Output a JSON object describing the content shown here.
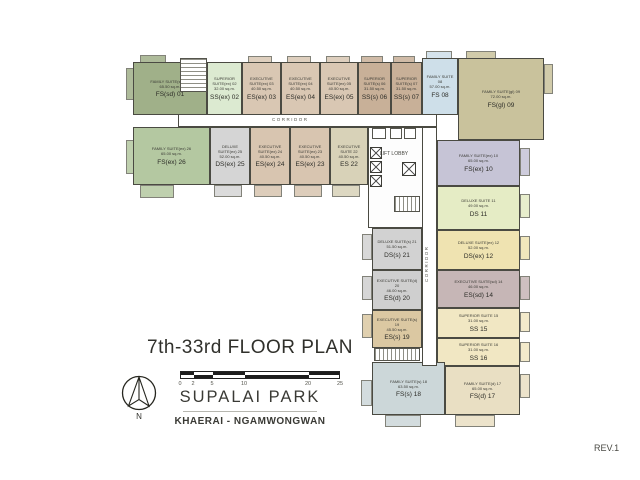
{
  "page": {
    "revision": "REV.1"
  },
  "title_block": {
    "title": "7th-33rd FLOOR PLAN",
    "project": "SUPALAI PARK",
    "location": "KHAERAI - NGAMWONGWAN",
    "north_label": "N",
    "scale_ticks": [
      "0",
      "2",
      "5",
      "10",
      "20",
      "25"
    ]
  },
  "labels": {
    "corridor_h": "CORRIDOR",
    "corridor_v": "CORRIDOR",
    "lift_lobby": "LIFT LOBBY"
  },
  "units": [
    {
      "number": "01",
      "name": "FAMILY SUITE(sd) 01",
      "area": "65.50 sq.m.",
      "code": "FS(sd) 01",
      "color": "#a0b089"
    },
    {
      "number": "02",
      "name": "SUPERIOR SUITE(ex) 02",
      "area": "32.00 sq.m.",
      "code": "SS(ex) 02",
      "color": "#dcead1"
    },
    {
      "number": "03",
      "name": "EXECUTIVE SUITE(ex) 03",
      "area": "40.50 sq.m.",
      "code": "ES(ex) 03",
      "color": "#d9c7b3"
    },
    {
      "number": "04",
      "name": "EXECUTIVE SUITE(ex) 04",
      "area": "40.50 sq.m.",
      "code": "ES(ex) 04",
      "color": "#d9c7b3"
    },
    {
      "number": "05",
      "name": "EXECUTIVE SUITE(ex) 05",
      "area": "40.50 sq.m.",
      "code": "ES(ex) 05",
      "color": "#d9c7b3"
    },
    {
      "number": "06",
      "name": "SUPERIOR SUITE(s) 06",
      "area": "31.50 sq.m.",
      "code": "SS(s) 06",
      "color": "#c8b098"
    },
    {
      "number": "07",
      "name": "SUPERIOR SUITE(s) 07",
      "area": "31.50 sq.m.",
      "code": "SS(s) 07",
      "color": "#c8b098"
    },
    {
      "number": "08",
      "name": "FAMILY SUITE 08",
      "area": "57.00 sq.m.",
      "code": "FS 08",
      "color": "#cedfe9"
    },
    {
      "number": "09",
      "name": "FAMILY SUITE(gl) 09",
      "area": "72.00 sq.m.",
      "code": "FS(gl) 09",
      "color": "#c9c29c"
    },
    {
      "number": "10",
      "name": "FAMILY SUITE(ex) 10",
      "area": "65.00 sq.m.",
      "code": "FS(ex) 10",
      "color": "#c6c4d6"
    },
    {
      "number": "11",
      "name": "DELUXE SUITE 11",
      "area": "49.00 sq.m.",
      "code": "DS 11",
      "color": "#e5ecc5"
    },
    {
      "number": "12",
      "name": "DELUXE SUITE(ex) 12",
      "area": "52.00 sq.m.",
      "code": "DS(ex) 12",
      "color": "#efe3b1"
    },
    {
      "number": "14",
      "name": "EXECUTIVE SUITE(sd) 14",
      "area": "46.00 sq.m.",
      "code": "ES(sd) 14",
      "color": "#c6b6b6"
    },
    {
      "number": "15",
      "name": "SUPERIOR SUITE 15",
      "area": "31.00 sq.m.",
      "code": "SS 15",
      "color": "#f1e7c3"
    },
    {
      "number": "16",
      "name": "SUPERIOR SUITE 16",
      "area": "31.00 sq.m.",
      "code": "SS 16",
      "color": "#f1e7c3"
    },
    {
      "number": "17",
      "name": "FAMILY SUITE(d) 17",
      "area": "65.00 sq.m.",
      "code": "FS(d) 17",
      "color": "#e9dfc3"
    },
    {
      "number": "18",
      "name": "FAMILY SUITE(s) 18",
      "area": "63.50 sq.m.",
      "code": "FS(s) 18",
      "color": "#ccd7d9"
    },
    {
      "number": "19",
      "name": "EXECUTIVE SUITE(s) 19",
      "area": "45.50 sq.m.",
      "code": "ES(s) 19",
      "color": "#dbc8a2"
    },
    {
      "number": "20",
      "name": "EXECUTIVE SUITE(d) 20",
      "area": "46.00 sq.m.",
      "code": "ES(d) 20",
      "color": "#cfcfcf"
    },
    {
      "number": "21",
      "name": "DELUXE SUITE(s) 21",
      "area": "51.50 sq.m.",
      "code": "DS(s) 21",
      "color": "#d2d2d2"
    },
    {
      "number": "22",
      "name": "EXECUTIVE SUITE 22",
      "area": "40.50 sq.m.",
      "code": "ES 22",
      "color": "#d8d2b8"
    },
    {
      "number": "23",
      "name": "EXECUTIVE SUITE(ex) 23",
      "area": "40.50 sq.m.",
      "code": "ES(ex) 23",
      "color": "#d8c5b0"
    },
    {
      "number": "24",
      "name": "EXECUTIVE SUITE(ex) 24",
      "area": "40.50 sq.m.",
      "code": "ES(ex) 24",
      "color": "#d8c5b0"
    },
    {
      "number": "25",
      "name": "DELUXE SUITE(ex) 25",
      "area": "52.00 sq.m.",
      "code": "DS(ex) 25",
      "color": "#d5d5d5"
    },
    {
      "number": "26",
      "name": "FAMILY SUITE(ex) 26",
      "area": "65.00 sq.m.",
      "code": "FS(ex) 26",
      "color": "#b4c8a1"
    }
  ]
}
